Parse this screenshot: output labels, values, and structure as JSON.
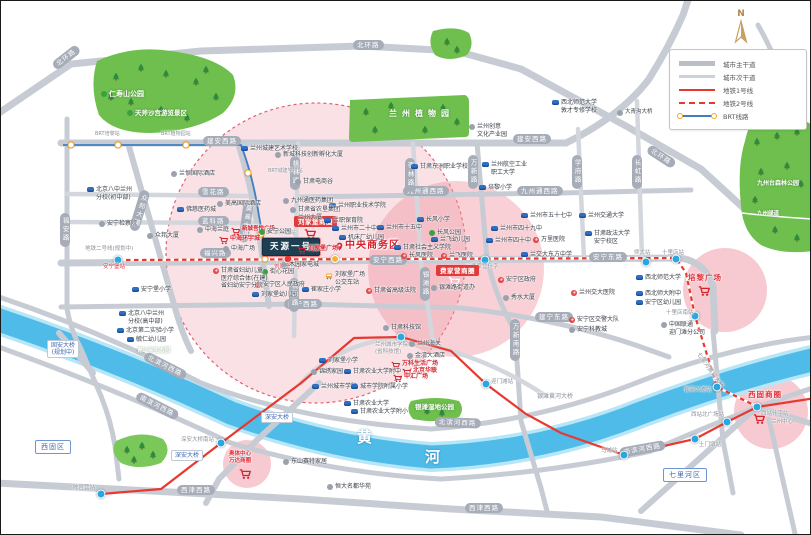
{
  "compass_label": "N",
  "legend": {
    "items": [
      {
        "label": "城市主干道",
        "type": "road-main"
      },
      {
        "label": "城市次干道",
        "type": "road-sub"
      },
      {
        "label": "地铁1号线",
        "type": "metro-1"
      },
      {
        "label": "地铁2号线",
        "type": "metro-2"
      },
      {
        "label": "BRT线路",
        "type": "brt"
      }
    ]
  },
  "colors": {
    "metro_red": "#e8382f",
    "brt_blue": "#3f7fc1",
    "brt_ring": "#f5a623",
    "river": "#4fbbe8",
    "park": "#6fbf4e",
    "circle_pink": "#f2a8b4",
    "road_gray": "#c7ccd4",
    "project_navy": "#1e3f52",
    "mall_red": "#d5232d"
  },
  "map": {
    "pois": [
      {
        "t": "仁寿山公园",
        "x": 100,
        "y": 89,
        "k": "park",
        "fs": 7,
        "ic": "t"
      },
      {
        "t": "天斧沙宫游览景区",
        "x": 126,
        "y": 108,
        "k": "park",
        "fs": 6.5,
        "ic": "t"
      },
      {
        "t": "兰州植物园",
        "x": 388,
        "y": 108,
        "k": "park",
        "fs": 8,
        "ls": 5
      },
      {
        "t": "九州台森林公园",
        "x": 756,
        "y": 179,
        "k": "park",
        "fs": 6
      },
      {
        "t": "九州绿道",
        "x": 756,
        "y": 210,
        "k": "park",
        "fs": 5.5
      },
      {
        "t": "银滩湿地公园",
        "x": 414,
        "y": 402,
        "k": "park",
        "fs": 6.5
      },
      {
        "t": "青少年生态园",
        "x": 136,
        "y": 347,
        "k": "park",
        "fs": 5.5
      },
      {
        "t": "黄",
        "x": 356,
        "y": 427,
        "k": "river"
      },
      {
        "t": "河",
        "x": 424,
        "y": 447,
        "k": "river"
      },
      {
        "t": [
          "固安大桥",
          "(规划中)"
        ],
        "x": 46,
        "y": 339,
        "k": "bluebox"
      },
      {
        "t": "深安大桥",
        "x": 260,
        "y": 411,
        "k": "bluebox"
      },
      {
        "t": "深安大桥",
        "x": 170,
        "y": 449,
        "k": "bluebox"
      },
      {
        "t": "银滩黄河大桥",
        "x": 536,
        "y": 392,
        "k": "stlabel",
        "fs": 6
      },
      {
        "t": "七里河黄河大桥",
        "x": 700,
        "y": 350,
        "k": "stlabel",
        "fs": 6,
        "r": 55
      },
      {
        "t": "西固区",
        "x": 34,
        "y": 439,
        "k": "district"
      },
      {
        "t": "七里河区",
        "x": 662,
        "y": 467,
        "k": "district"
      },
      {
        "t": "建安西路",
        "x": 202,
        "y": 135,
        "k": "rbox"
      },
      {
        "t": "建安西路",
        "x": 512,
        "y": 133,
        "k": "rbox"
      },
      {
        "t": "雪花路",
        "x": 197,
        "y": 186,
        "k": "rbox"
      },
      {
        "t": "蓝科路",
        "x": 197,
        "y": 215,
        "k": "rbox"
      },
      {
        "t": "福兴路",
        "x": 199,
        "y": 247,
        "k": "rbox"
      },
      {
        "t": "安宁西路",
        "x": 368,
        "y": 254,
        "k": "rbox"
      },
      {
        "t": "安宁东路",
        "x": 588,
        "y": 251,
        "k": "rbox"
      },
      {
        "t": "建宁西路",
        "x": 283,
        "y": 298,
        "k": "rbox"
      },
      {
        "t": "建宁东路",
        "x": 534,
        "y": 311,
        "k": "rbox"
      },
      {
        "t": "九州通西路",
        "x": 402,
        "y": 185,
        "k": "rbox"
      },
      {
        "t": "九州通西路",
        "x": 516,
        "y": 185,
        "k": "rbox"
      },
      {
        "t": "北环路",
        "x": 352,
        "y": 39,
        "k": "rbox"
      },
      {
        "t": "北环路",
        "x": 50,
        "y": 62,
        "k": "rbox",
        "r": -38
      },
      {
        "t": "北环路",
        "x": 650,
        "y": 143,
        "k": "rbox",
        "r": 33
      },
      {
        "t": "西津西路",
        "x": 176,
        "y": 484,
        "k": "rbox"
      },
      {
        "t": "西津西路",
        "x": 464,
        "y": 502,
        "k": "rbox"
      },
      {
        "t": "北滨河西路",
        "x": 146,
        "y": 350,
        "k": "rbox",
        "r": 27
      },
      {
        "t": "北滨河西路",
        "x": 434,
        "y": 416,
        "k": "rbox",
        "r": 2
      },
      {
        "t": "南滨河西路",
        "x": 138,
        "y": 390,
        "k": "rbox",
        "r": 27
      },
      {
        "t": "南滨河西路",
        "x": 618,
        "y": 447,
        "k": "rbox",
        "r": -10
      },
      {
        "t": "福安路",
        "x": 59,
        "y": 212,
        "k": "rboxv"
      },
      {
        "t": "众邦大道",
        "x": 140,
        "y": 188,
        "k": "rboxv",
        "r": 17
      },
      {
        "t": "莫高大道",
        "x": 243,
        "y": 199,
        "k": "rboxv",
        "r": 8
      },
      {
        "t": "桃林路",
        "x": 289,
        "y": 155,
        "k": "rboxv"
      },
      {
        "t": "桃林路",
        "x": 288,
        "y": 277,
        "k": "rboxv"
      },
      {
        "t": "枣林路",
        "x": 404,
        "y": 157,
        "k": "rboxv"
      },
      {
        "t": "银滩路",
        "x": 419,
        "y": 266,
        "k": "rboxv"
      },
      {
        "t": "万新路",
        "x": 467,
        "y": 154,
        "k": "rboxv"
      },
      {
        "t": "万新南路",
        "x": 509,
        "y": 318,
        "k": "rboxv"
      },
      {
        "t": "学府路",
        "x": 571,
        "y": 154,
        "k": "rboxv"
      },
      {
        "t": "长虹路",
        "x": 631,
        "y": 154,
        "k": "rboxv"
      },
      {
        "x": 100,
        "y": 493,
        "k": "dot"
      },
      {
        "x": 220,
        "y": 442,
        "k": "dot"
      },
      {
        "x": 400,
        "y": 336,
        "k": "dot"
      },
      {
        "x": 485,
        "y": 383,
        "k": "dot"
      },
      {
        "x": 623,
        "y": 454,
        "k": "dot"
      },
      {
        "x": 694,
        "y": 438,
        "k": "dot"
      },
      {
        "x": 726,
        "y": 421,
        "k": "dot"
      },
      {
        "x": 756,
        "y": 406,
        "k": "dot"
      },
      {
        "x": 117,
        "y": 259,
        "k": "dot"
      },
      {
        "x": 484,
        "y": 259,
        "k": "dot"
      },
      {
        "x": 645,
        "y": 261,
        "k": "dot"
      },
      {
        "x": 675,
        "y": 258,
        "k": "dot"
      },
      {
        "x": 694,
        "y": 315,
        "k": "dot"
      },
      {
        "x": 716,
        "y": 386,
        "k": "dot"
      },
      {
        "x": 287,
        "y": 258,
        "k": "dot",
        "c": "red"
      },
      {
        "x": 334,
        "y": 258,
        "k": "dot",
        "c": "bus"
      },
      {
        "x": 70,
        "y": 144,
        "k": "dot",
        "c": "brt"
      },
      {
        "x": 117,
        "y": 144,
        "k": "dot",
        "c": "brt"
      },
      {
        "x": 185,
        "y": 144,
        "k": "dot",
        "c": "brt"
      },
      {
        "x": 247,
        "y": 172,
        "k": "dot",
        "c": "brt"
      },
      {
        "x": 260,
        "y": 233,
        "k": "dot",
        "c": "brt"
      },
      {
        "x": 264,
        "y": 258,
        "k": "dot",
        "c": "brt"
      },
      {
        "t": "陈官营站",
        "x": 72,
        "y": 484,
        "k": "stlabel"
      },
      {
        "t": "深安大桥南站",
        "x": 180,
        "y": 436,
        "k": "stlabel"
      },
      {
        "t": [
          "兰州城市学院站",
          "(省科技馆)"
        ],
        "x": 374,
        "y": 341,
        "k": "stlabel"
      },
      {
        "t": "迎门滩站",
        "x": 490,
        "y": 378,
        "k": "stlabel"
      },
      {
        "t": "马滩站",
        "x": 600,
        "y": 447,
        "k": "stlabel"
      },
      {
        "t": "土门墩站",
        "x": 698,
        "y": 441,
        "k": "stlabel"
      },
      {
        "t": "西站北广场站",
        "x": 690,
        "y": 411,
        "k": "stlabel"
      },
      {
        "t": "西站什字站",
        "x": 760,
        "y": 410,
        "k": "stlabel"
      },
      {
        "t": "费家营什字",
        "x": 470,
        "y": 263,
        "k": "stlabel"
      },
      {
        "t": "师大站",
        "x": 633,
        "y": 249,
        "k": "stlabel"
      },
      {
        "t": "十里店站",
        "x": 661,
        "y": 249,
        "k": "stlabel"
      },
      {
        "t": "十里店南站",
        "x": 665,
        "y": 309,
        "k": "stlabel"
      },
      {
        "t": "崔家大滩站",
        "x": 683,
        "y": 386,
        "k": "stlabel"
      },
      {
        "t": "安宁堡站",
        "x": 102,
        "y": 263,
        "k": "redtiny"
      },
      {
        "t": "刘家堡什字",
        "x": 273,
        "y": 263,
        "k": "redtiny"
      },
      {
        "t": "地铁二号线(规划中)",
        "x": 84,
        "y": 245,
        "k": "stlabel"
      },
      {
        "t": "BRT培黎站",
        "x": 94,
        "y": 130,
        "k": "stlabel",
        "fs": 5
      },
      {
        "t": "BRT植物园站",
        "x": 160,
        "y": 130,
        "k": "stlabel",
        "fs": 5
      },
      {
        "t": "BRT城建学校站",
        "x": 267,
        "y": 167,
        "k": "stlabel",
        "fs": 5
      },
      {
        "t": "BRT刘家堡站",
        "x": 265,
        "y": 229,
        "k": "stlabel",
        "fs": 5
      },
      {
        "t": "刘家堡商圈",
        "x": 293,
        "y": 215,
        "k": "mallbox"
      },
      {
        "x": 303,
        "y": 227,
        "k": "cart"
      },
      {
        "t": "费家营商圈",
        "x": 435,
        "y": 264,
        "k": "mallbox"
      },
      {
        "x": 447,
        "y": 275,
        "k": "cartw"
      },
      {
        "t": "培黎广场",
        "x": 687,
        "y": 272,
        "k": "bigmall"
      },
      {
        "x": 697,
        "y": 284,
        "k": "cart"
      },
      {
        "t": "西固商圈",
        "x": 747,
        "y": 389,
        "k": "bigmall"
      },
      {
        "x": 752,
        "y": 412,
        "k": "cart"
      },
      {
        "t": "兰州中心",
        "x": 770,
        "y": 418,
        "k": "stlabel",
        "fs": 5.5
      },
      {
        "t": [
          "奥体中心",
          "万达商圈"
        ],
        "x": 228,
        "y": 450,
        "k": "bigmall2"
      },
      {
        "x": 238,
        "y": 467,
        "k": "cart"
      },
      {
        "t": "中央商务区",
        "x": 334,
        "y": 239,
        "k": "cbd",
        "n": "cbd-label"
      },
      {
        "t": "天源一号",
        "x": 261,
        "y": 237,
        "k": "project",
        "n": "project-title"
      },
      {
        "t": "刘家堡广场",
        "x": 296,
        "y": 244,
        "k": "mall",
        "ic": "c"
      },
      {
        "t": "中海环宇城",
        "x": 218,
        "y": 234,
        "k": "mall",
        "ic": "c"
      },
      {
        "t": "新城吾悦广场",
        "x": 230,
        "y": 225,
        "k": "mall",
        "ic": "c",
        "fs": 5.5
      },
      {
        "t": "万科生活广场",
        "x": 390,
        "y": 359,
        "k": "mall",
        "ic": "c"
      },
      {
        "t": "北京华联",
        "x": 401,
        "y": 366,
        "k": "mall",
        "ic": "c"
      },
      {
        "t": "中汇广场",
        "x": 392,
        "y": 372,
        "k": "mall",
        "ic": "c"
      },
      {
        "t": [
          "北京八中兰州",
          "分校(初中部)"
        ],
        "x": 86,
        "y": 185,
        "k": "poi",
        "ic": "b"
      },
      {
        "t": [
          "北京八中兰州",
          "分校(高中部)"
        ],
        "x": 118,
        "y": 309,
        "k": "poi",
        "ic": "b"
      },
      {
        "t": "北京第二实验小学",
        "x": 116,
        "y": 326,
        "k": "poi",
        "ic": "b"
      },
      {
        "t": "毓仁幼儿园",
        "x": 126,
        "y": 335,
        "k": "poi",
        "ic": "b"
      },
      {
        "t": "安宁堡小学",
        "x": 131,
        "y": 285,
        "k": "poi",
        "ic": "b"
      },
      {
        "t": "兰州城建艺术学校",
        "x": 240,
        "y": 144,
        "k": "poi",
        "ic": "b"
      },
      {
        "t": "甘肃东洲职业学校",
        "x": 410,
        "y": 162,
        "k": "poi",
        "ic": "b"
      },
      {
        "t": "佛慈医药城",
        "x": 176,
        "y": 205,
        "k": "poi",
        "ic": "b"
      },
      {
        "t": "兰州职业技术学院",
        "x": 328,
        "y": 201,
        "k": "poi",
        "ic": "b"
      },
      {
        "t": "兰职保育院",
        "x": 323,
        "y": 216,
        "k": "poi",
        "ic": "b"
      },
      {
        "t": "兰州市二十中",
        "x": 331,
        "y": 224,
        "k": "poi",
        "ic": "b"
      },
      {
        "t": "机床厂幼儿园",
        "x": 338,
        "y": 233,
        "k": "poi",
        "ic": "b"
      },
      {
        "t": "刘家堡幼儿园",
        "x": 251,
        "y": 290,
        "k": "poi",
        "ic": "b"
      },
      {
        "t": "崔家庄小学",
        "x": 301,
        "y": 285,
        "k": "poi",
        "ic": "b"
      },
      {
        "t": "刘家堡小学",
        "x": 318,
        "y": 356,
        "k": "poi",
        "ic": "b"
      },
      {
        "t": "甘肃农业大学附中",
        "x": 343,
        "y": 367,
        "k": "poi",
        "ic": "b"
      },
      {
        "t": "兰州城市学院",
        "x": 311,
        "y": 382,
        "k": "poi",
        "ic": "b"
      },
      {
        "t": "城市学院附属小学",
        "x": 350,
        "y": 382,
        "k": "poi",
        "ic": "b"
      },
      {
        "t": "甘肃农业大学",
        "x": 343,
        "y": 399,
        "k": "poi",
        "ic": "b"
      },
      {
        "t": "甘肃农业大学附小",
        "x": 350,
        "y": 407,
        "k": "poi",
        "ic": "b"
      },
      {
        "t": "长风小学",
        "x": 416,
        "y": 215,
        "k": "poi",
        "ic": "b"
      },
      {
        "t": "兰飞幼儿园",
        "x": 430,
        "y": 235,
        "k": "poi",
        "ic": "b"
      },
      {
        "t": "兰州市十五中",
        "x": 376,
        "y": 223,
        "k": "poi",
        "ic": "b"
      },
      {
        "t": "甘肃社会主义学院",
        "x": 393,
        "y": 243,
        "k": "poi",
        "ic": "b"
      },
      {
        "t": "培黎小学",
        "x": 478,
        "y": 183,
        "k": "poi",
        "ic": "b"
      },
      {
        "t": [
          "兰州航空工业",
          "职工大学"
        ],
        "x": 481,
        "y": 160,
        "k": "poi",
        "ic": "b"
      },
      {
        "t": [
          "西北师范大学",
          "敦才专修学校"
        ],
        "x": 551,
        "y": 98,
        "k": "poi",
        "ic": "b"
      },
      {
        "t": "兰州市五十七中",
        "x": 520,
        "y": 211,
        "k": "poi",
        "ic": "b"
      },
      {
        "t": "兰州市四十九中",
        "x": 490,
        "y": 224,
        "k": "poi",
        "ic": "b"
      },
      {
        "t": "兰州市四十中",
        "x": 485,
        "y": 236,
        "k": "poi",
        "ic": "b"
      },
      {
        "t": "兰交大东方中学",
        "x": 520,
        "y": 250,
        "k": "poi",
        "ic": "b"
      },
      {
        "t": "兰州交通大学",
        "x": 578,
        "y": 211,
        "k": "poi",
        "ic": "b"
      },
      {
        "t": [
          "甘肃政法大学",
          "安宁校区"
        ],
        "x": 584,
        "y": 229,
        "k": "poi",
        "ic": "b"
      },
      {
        "t": "西北师范大学",
        "x": 635,
        "y": 273,
        "k": "poi",
        "ic": "b"
      },
      {
        "t": "西北师大附中",
        "x": 635,
        "y": 289,
        "k": "poi",
        "ic": "b"
      },
      {
        "t": "安宁区幼儿园",
        "x": 635,
        "y": 298,
        "k": "poi",
        "ic": "b"
      },
      {
        "t": "安宁检察院",
        "x": 98,
        "y": 219,
        "k": "poi",
        "ic": "g"
      },
      {
        "t": "新城科技创新孵化大厦",
        "x": 274,
        "y": 150,
        "k": "poi",
        "ic": "g"
      },
      {
        "t": "甘肃电商谷",
        "x": 294,
        "y": 177,
        "k": "poi",
        "ic": "g"
      },
      {
        "t": "九州通医药集团",
        "x": 282,
        "y": 196,
        "k": "poi",
        "ic": "g"
      },
      {
        "t": [
          "甘肃省农垦集团",
          "兰州大厦"
        ],
        "x": 289,
        "y": 205,
        "k": "poi",
        "ic": "g"
      },
      {
        "t": "兰恒国际酒店",
        "x": 170,
        "y": 169,
        "k": "poi",
        "ic": "g"
      },
      {
        "t": "美高国际酒店",
        "x": 216,
        "y": 199,
        "k": "poi",
        "ic": "g"
      },
      {
        "t": "中海兰庭",
        "x": 196,
        "y": 225,
        "k": "poi",
        "ic": "g"
      },
      {
        "t": "众邦大厦",
        "x": 146,
        "y": 231,
        "k": "poi",
        "ic": "g"
      },
      {
        "t": "中海广场",
        "x": 222,
        "y": 244,
        "k": "poi",
        "ic": "g"
      },
      {
        "t": "木园家电城",
        "x": 280,
        "y": 260,
        "k": "poi",
        "ic": "g"
      },
      {
        "t": "甘肃科技馆",
        "x": 382,
        "y": 323,
        "k": "poi",
        "ic": "g"
      },
      {
        "t": "兰州海关",
        "x": 408,
        "y": 339,
        "k": "poi",
        "ic": "g"
      },
      {
        "t": "金湾大酒店",
        "x": 406,
        "y": 351,
        "k": "poi",
        "ic": "g"
      },
      {
        "t": "锦绣家园",
        "x": 310,
        "y": 367,
        "k": "poi",
        "ic": "g"
      },
      {
        "t": "银滩路街道办",
        "x": 430,
        "y": 283,
        "k": "poi",
        "ic": "g"
      },
      {
        "t": "秀水大厦",
        "x": 502,
        "y": 293,
        "k": "poi",
        "ic": "g"
      },
      {
        "t": "安宁科教城",
        "x": 568,
        "y": 325,
        "k": "poi",
        "ic": "g"
      },
      {
        "t": [
          "中国联通",
          "迎门滩分公司"
        ],
        "x": 660,
        "y": 320,
        "k": "poi",
        "ic": "g"
      },
      {
        "t": "大青沟大桥",
        "x": 616,
        "y": 108,
        "k": "poi",
        "ic": "g",
        "fs": 5.5
      },
      {
        "t": [
          "兰州创意",
          "文化产业园"
        ],
        "x": 468,
        "y": 122,
        "k": "poi",
        "ic": "g"
      },
      {
        "t": "东山赛特家居",
        "x": 282,
        "y": 457,
        "k": "poi",
        "ic": "g"
      },
      {
        "t": "恒大名都华苑",
        "x": 326,
        "y": 482,
        "k": "poi",
        "ic": "g"
      },
      {
        "t": "安宁公园",
        "x": 258,
        "y": 227,
        "k": "poi",
        "ic": "t"
      },
      {
        "t": "街心花园",
        "x": 261,
        "y": 267,
        "k": "poi",
        "ic": "t"
      },
      {
        "t": "长风公园",
        "x": 428,
        "y": 228,
        "k": "poi",
        "ic": "t"
      },
      {
        "t": "安宁区人民政府",
        "x": 254,
        "y": 280,
        "k": "poi",
        "ic": "r"
      },
      {
        "t": "甘肃省高级法院",
        "x": 365,
        "y": 286,
        "k": "poi",
        "ic": "r"
      },
      {
        "t": "长风医院",
        "x": 400,
        "y": 251,
        "k": "poi",
        "ic": "r"
      },
      {
        "t": "兰飞医院",
        "x": 440,
        "y": 251,
        "k": "poi",
        "ic": "r"
      },
      {
        "t": "万里医院",
        "x": 532,
        "y": 235,
        "k": "poi",
        "ic": "r"
      },
      {
        "t": "安宁区政府",
        "x": 497,
        "y": 275,
        "k": "poi",
        "ic": "r"
      },
      {
        "t": "兰州交大医院",
        "x": 570,
        "y": 288,
        "k": "poi",
        "ic": "r"
      },
      {
        "t": "安宁区交警大队",
        "x": 568,
        "y": 315,
        "k": "poi",
        "ic": "r"
      },
      {
        "t": [
          "甘肃省妇幼儿童",
          "医疗综合体(在建)",
          "省妇幼安宁分院"
        ],
        "x": 212,
        "y": 266,
        "k": "poi",
        "ic": "r"
      },
      {
        "t": [
          "刘家堡广场",
          "公交车站"
        ],
        "x": 324,
        "y": 270,
        "k": "poi",
        "ic": "bus"
      }
    ]
  }
}
